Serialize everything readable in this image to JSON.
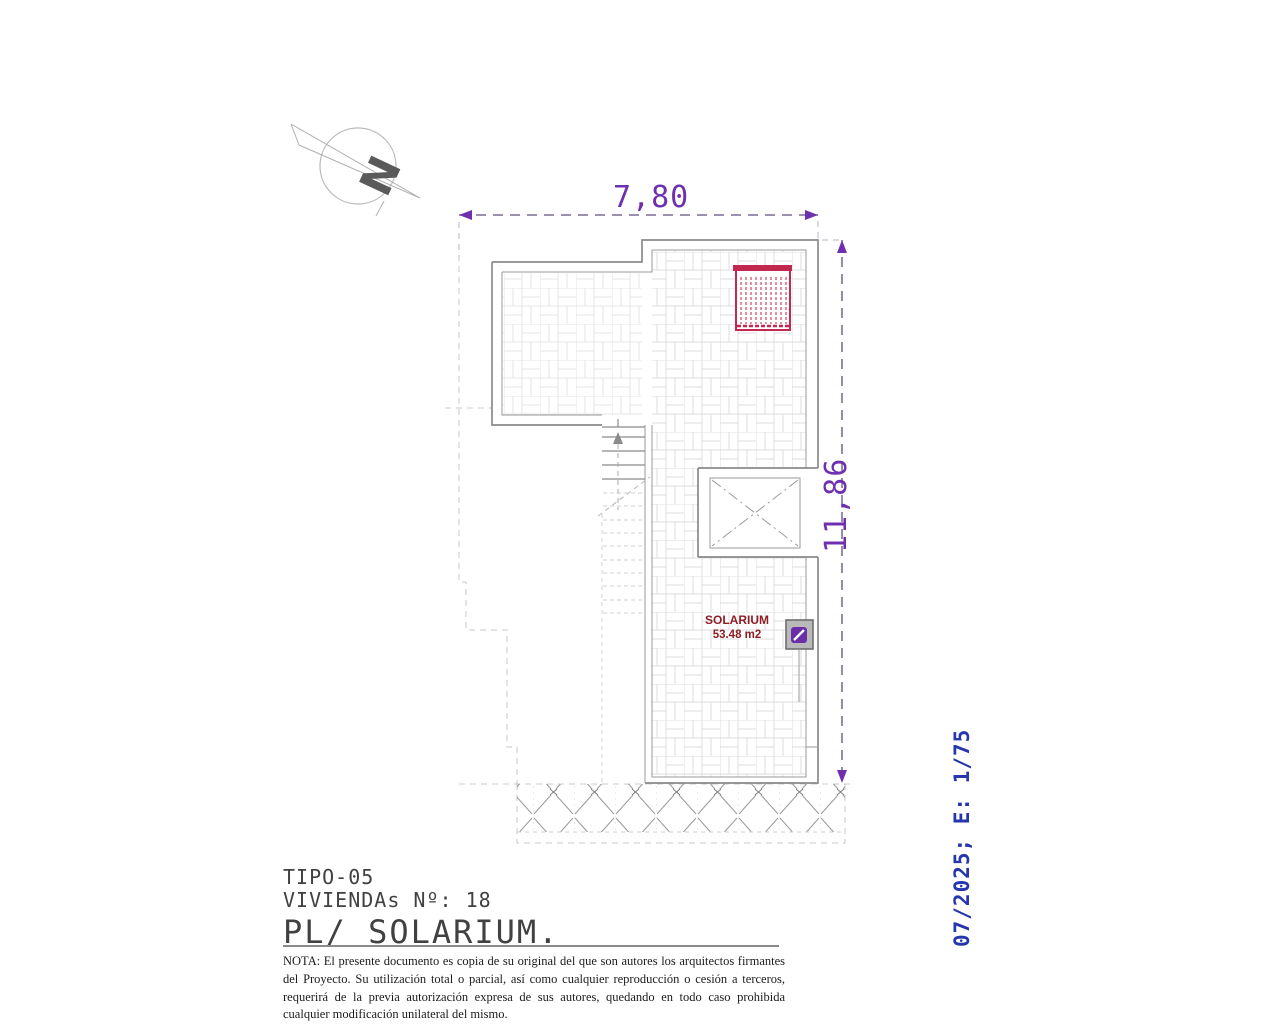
{
  "drawing": {
    "kind": "architectural-floor-plan",
    "north_letter": "N"
  },
  "dimensions": {
    "width_label": "7,80",
    "height_label": "11,86"
  },
  "room": {
    "name": "SOLARIUM",
    "area": "53.48 m2"
  },
  "title_block": {
    "line1": "TIPO-05",
    "line2": "VIVIENDAs Nº: 18",
    "line3": "PL/ SOLARIUM."
  },
  "note": {
    "text": "NOTA: El presente documento es copia de su original del que son autores los arquitectos firmantes del Proyecto. Su utilización total o parcial, así como cualquier reproducción o cesión a terceros, requerirá  de la previa autorización expresa de sus autores, quedando en todo caso prohibida cualquier modificación unilateral del mismo."
  },
  "stamp": {
    "text": "07/2025; E: 1/75"
  },
  "colors": {
    "dimension_purple": "#6e2fb0",
    "dimension_line": "#5f4d85",
    "pergola_red": "#c22850",
    "room_label_red": "#8c1f26",
    "stamp_blue": "#2636ae",
    "wall_gray": "#8a8a8a",
    "tile_gray": "#dcdcdc",
    "drain_purple": "#6a2fa8"
  }
}
